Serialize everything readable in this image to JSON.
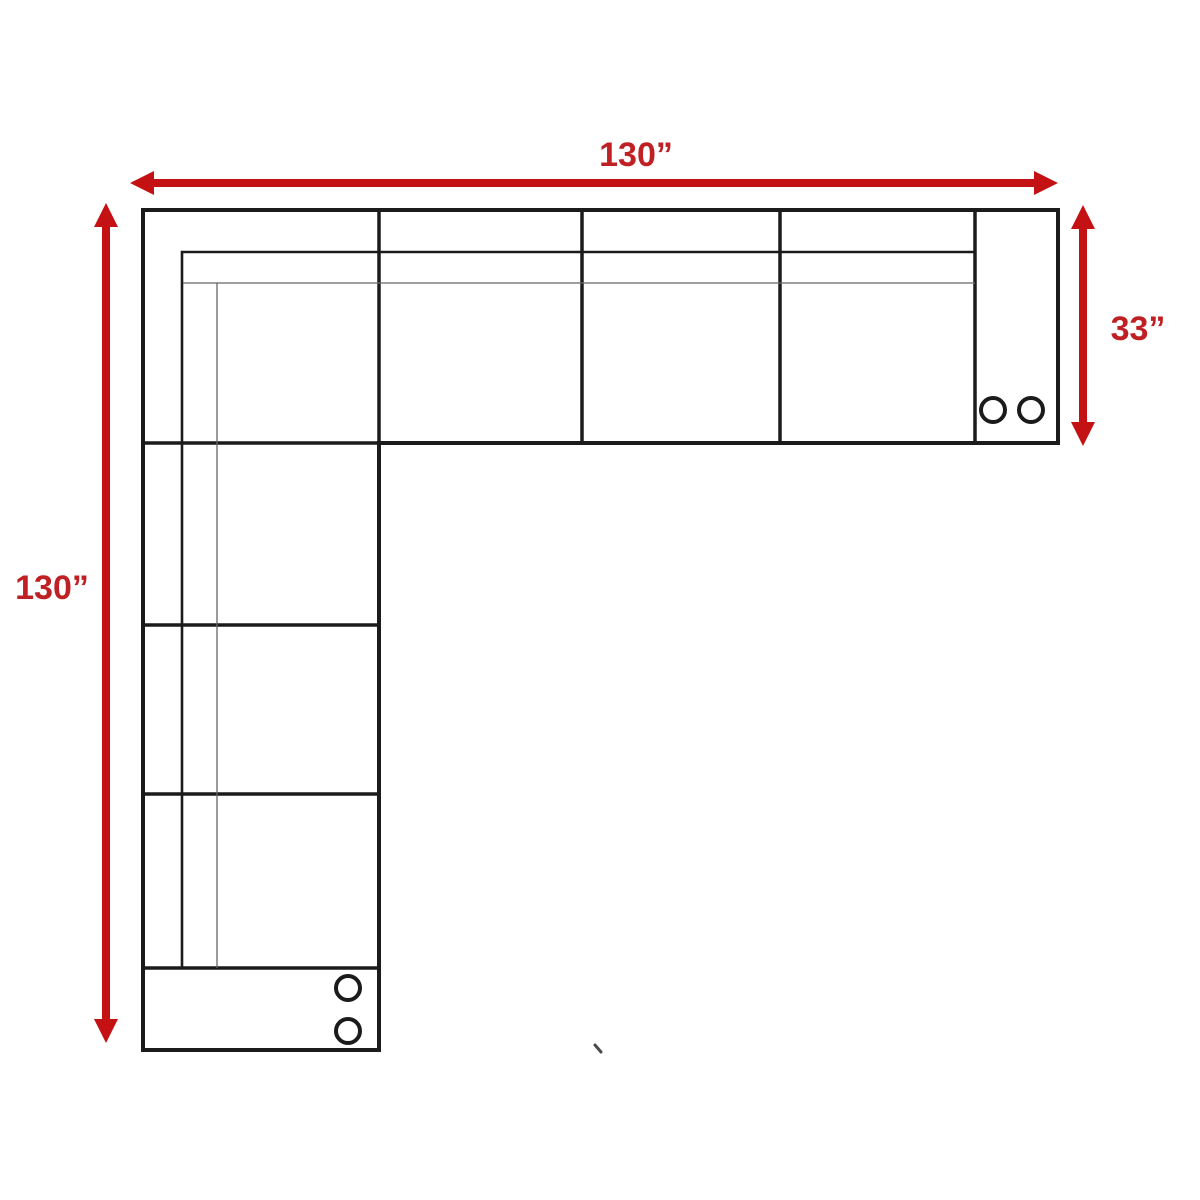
{
  "diagram": {
    "type": "sectional-sofa-dimension-drawing"
  },
  "dimension_labels": {
    "width": "130”",
    "height": "130”",
    "depth": "33”"
  },
  "colors": {
    "accent": "#c41113",
    "label_red": "#bf2024",
    "outline": "#1b1b1b",
    "thin_line": "#666666",
    "stray_mark": "#4a4a4a",
    "background": "#ffffff"
  }
}
